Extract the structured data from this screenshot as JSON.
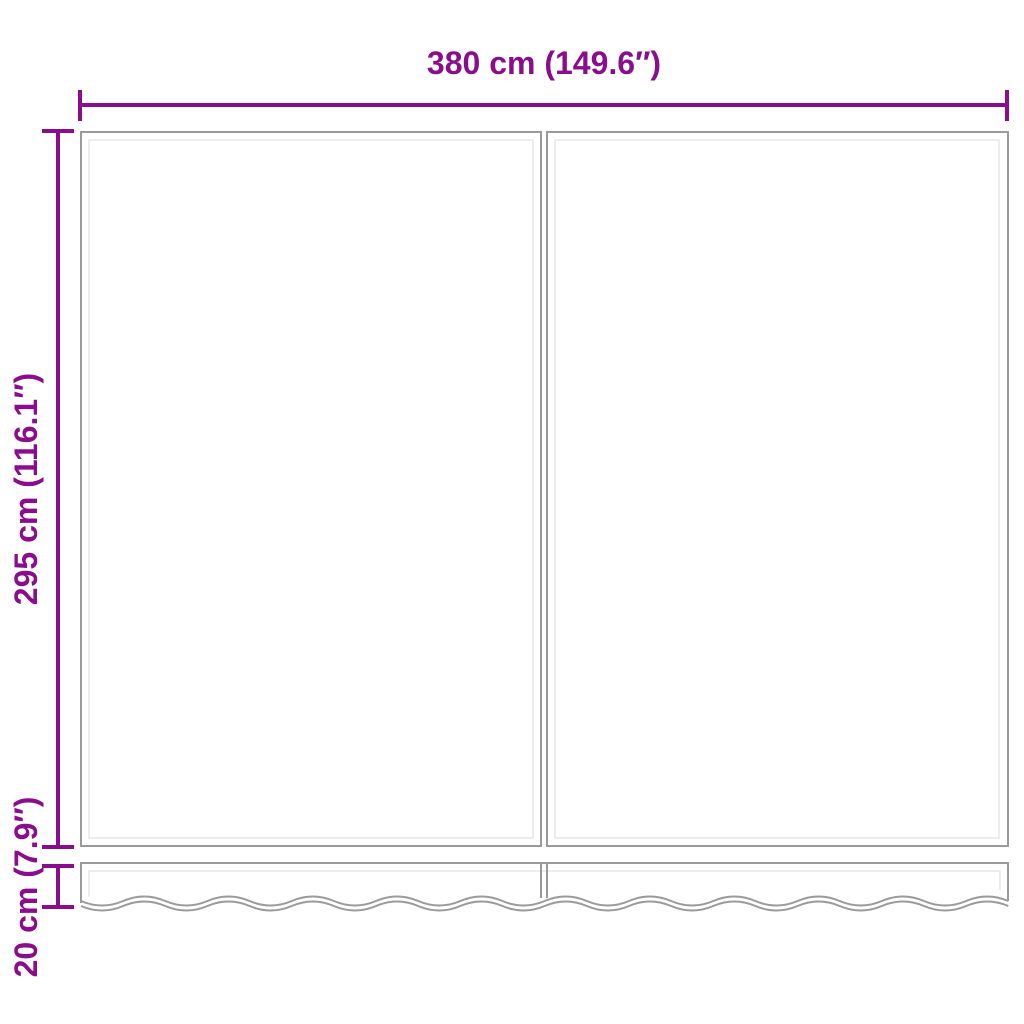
{
  "colors": {
    "dimension": "#8A0D8B",
    "outline": "#9A9A9A",
    "hem": "#DBDBDB",
    "background": "#FFFFFF"
  },
  "diagram": {
    "width_dim": {
      "label": "380 cm (149.6″)"
    },
    "height_dim": {
      "label": "295 cm (116.1″)"
    },
    "valance_dim": {
      "label": "20 cm (7.9″)"
    }
  }
}
